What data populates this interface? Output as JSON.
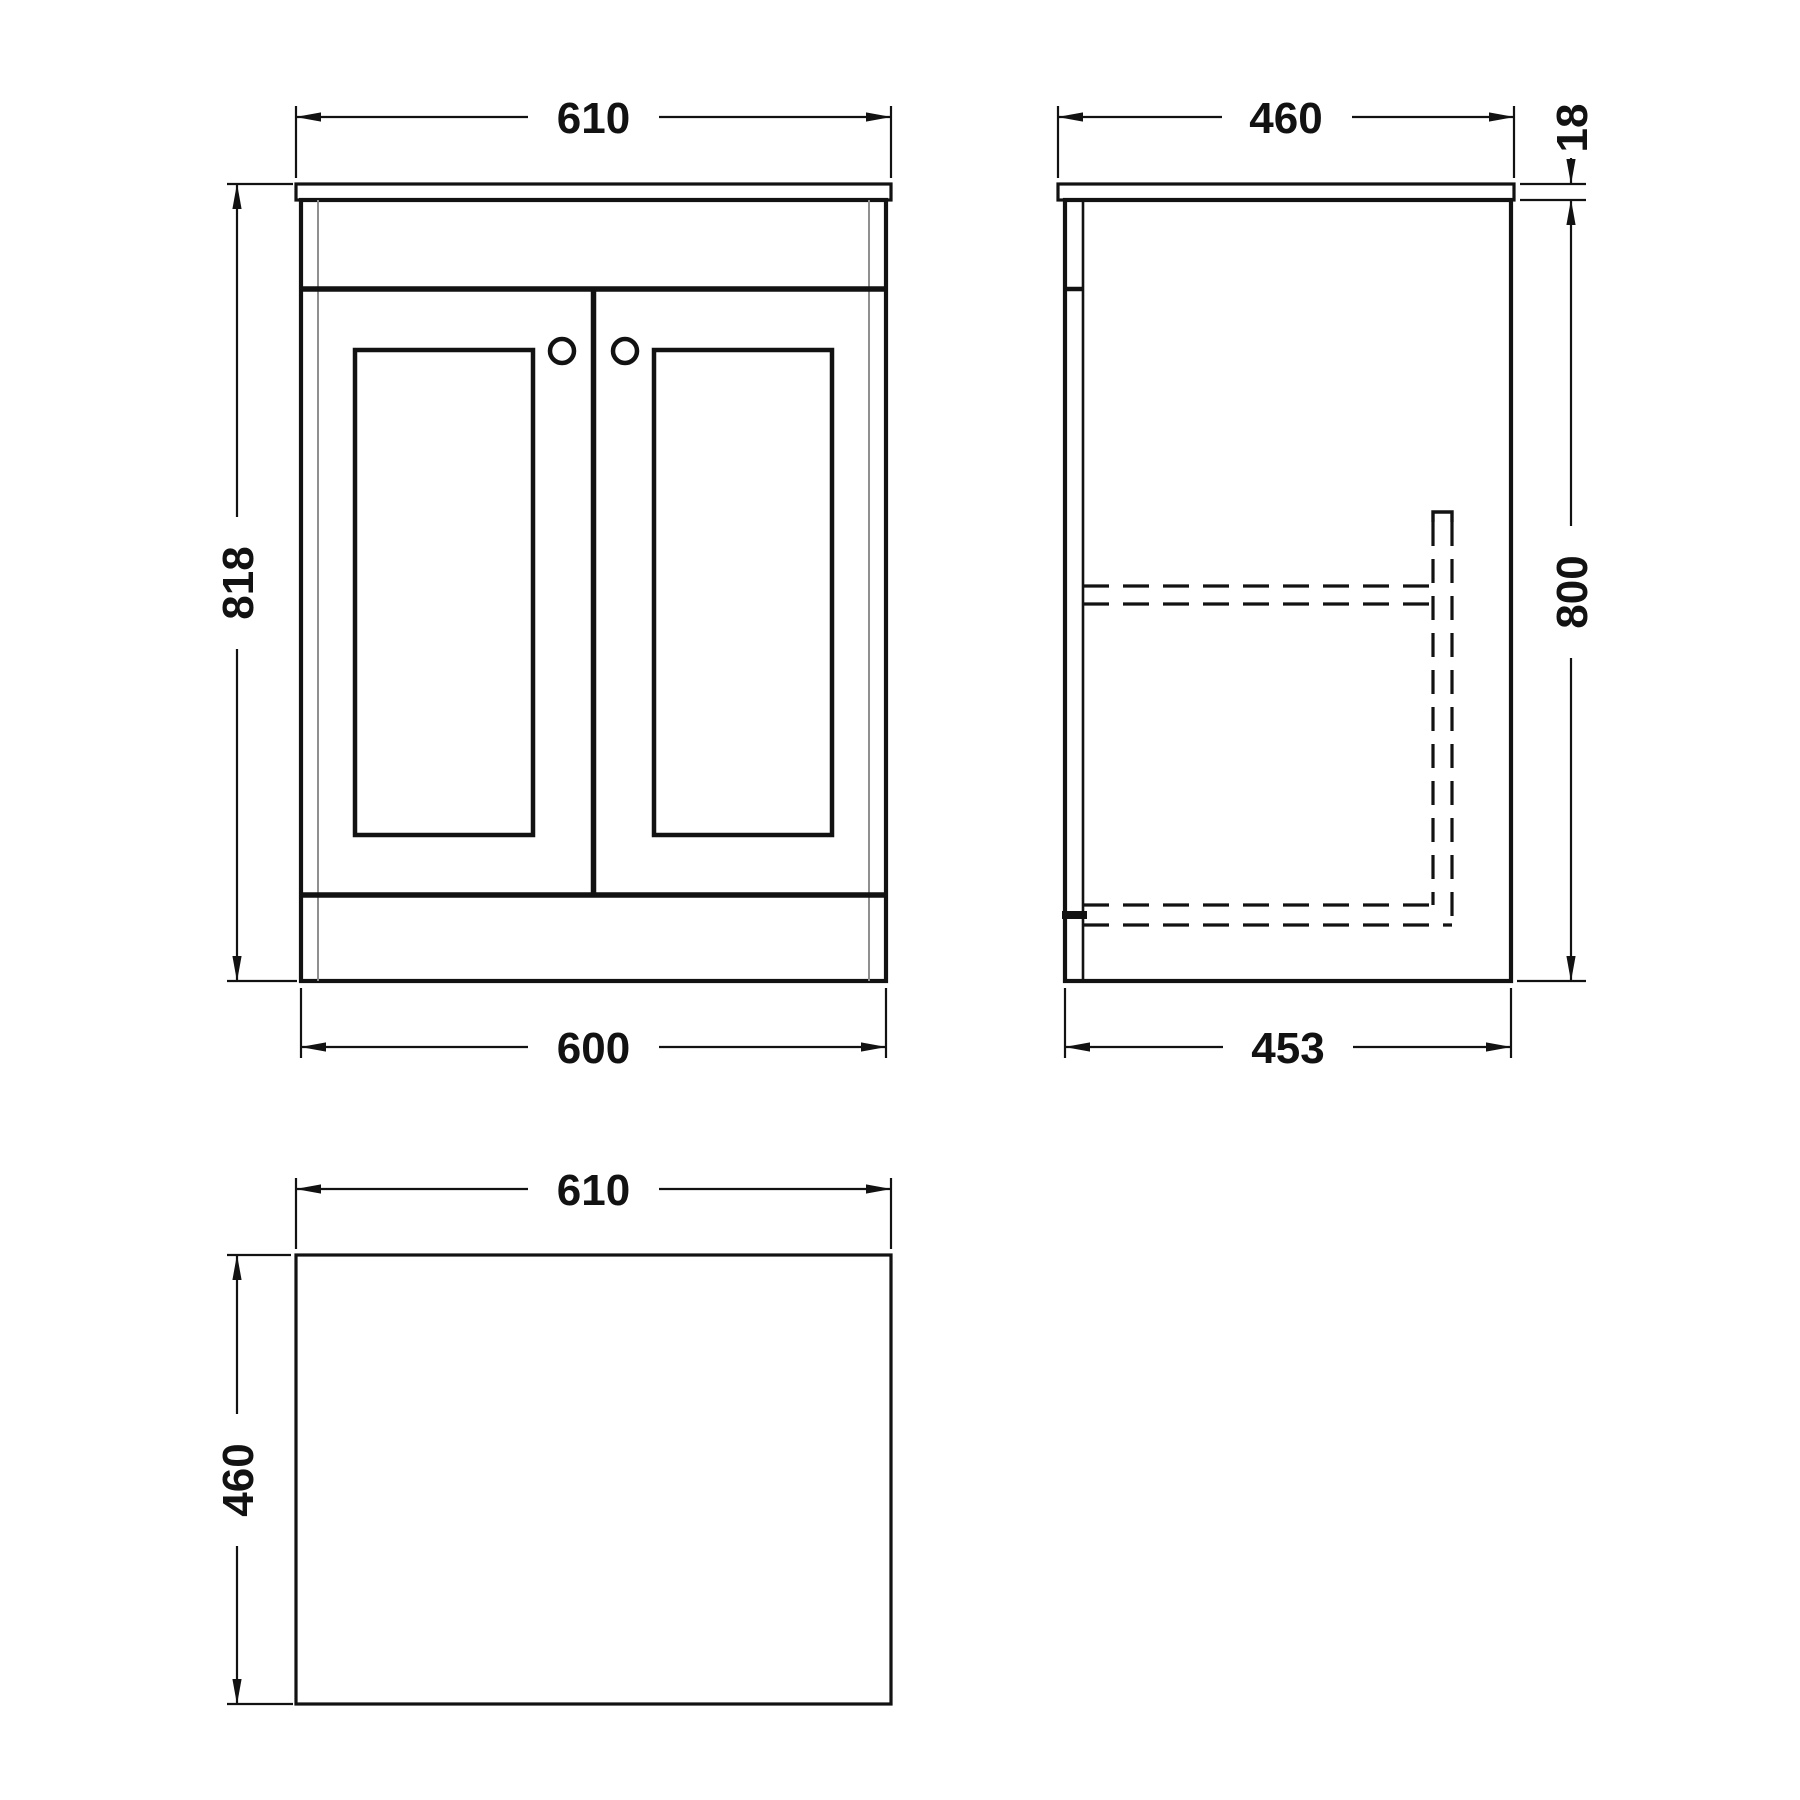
{
  "document": {
    "type": "technical-drawing",
    "subject": "Bathroom vanity unit with two panelled doors — dimensioned orthographic views (front, side, plan)",
    "units": "mm"
  },
  "views": {
    "front": {
      "label": "front-view",
      "width_including_top": "610",
      "overall_height": "818",
      "cabinet_width": "600"
    },
    "side": {
      "label": "side-view",
      "depth_including_top": "460",
      "top_thickness": "18",
      "cabinet_height": "800",
      "cabinet_depth": "453"
    },
    "plan": {
      "label": "plan-view",
      "width": "610",
      "depth": "460"
    }
  },
  "colors": {
    "line": "#121212",
    "thin_line": "#8f8f8f",
    "background": "#ffffff"
  }
}
